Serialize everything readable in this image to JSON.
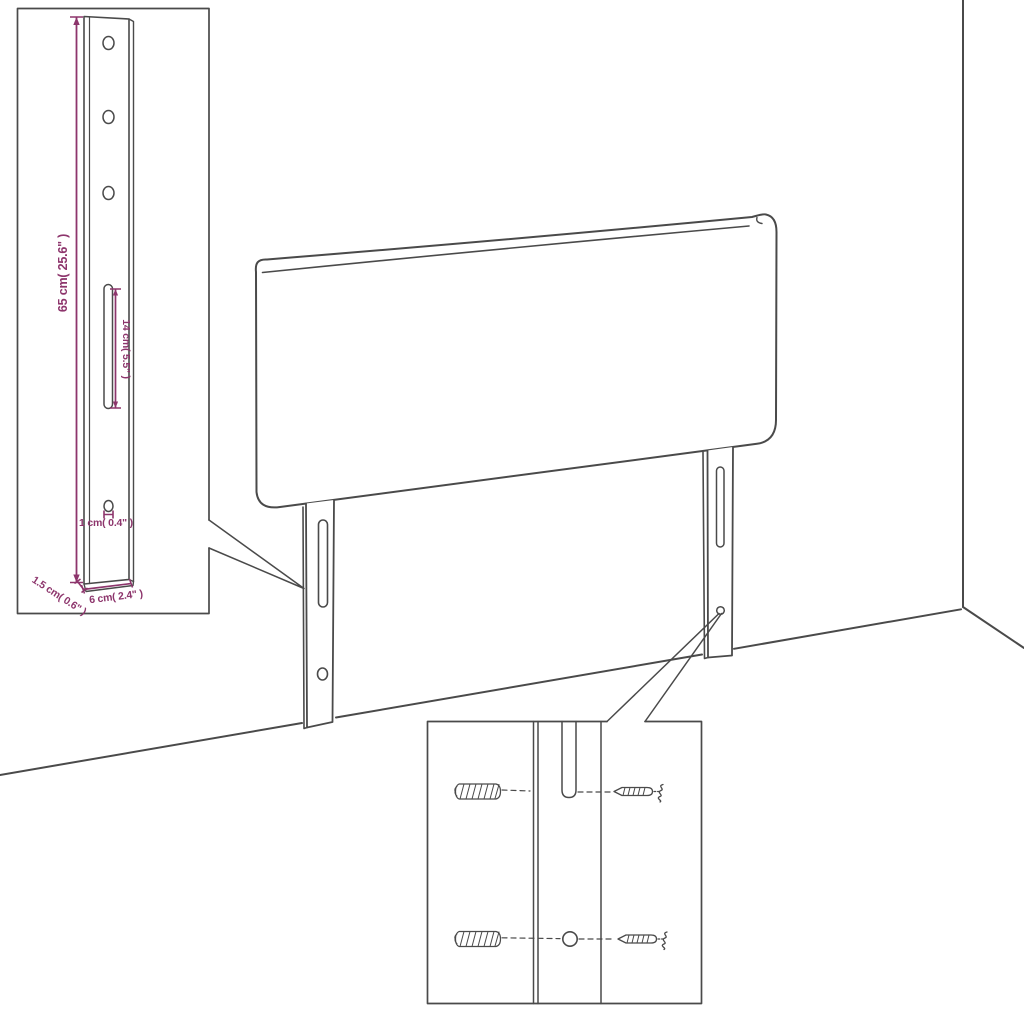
{
  "scene": {
    "description": "Assembly dimension diagram of an upholstered headboard with two mounting leg brackets placed against a wall corner; a detail inset shows the bracket dimensions and a second inset shows the wall-plug and screw fixing hardware",
    "colors": {
      "line": "#4a4a4a",
      "dimension": "#8d356c",
      "background": "#ffffff"
    }
  },
  "bracket_inset": {
    "labels": {
      "height": "65 cm( 25.6\" )",
      "slot_length": "14 cm( 5.5\" )",
      "hole_diameter": "1 cm( 0.4\" )",
      "thickness": "1.5 cm( 0.6\" )",
      "width": "6 cm( 2.4\" )"
    }
  }
}
